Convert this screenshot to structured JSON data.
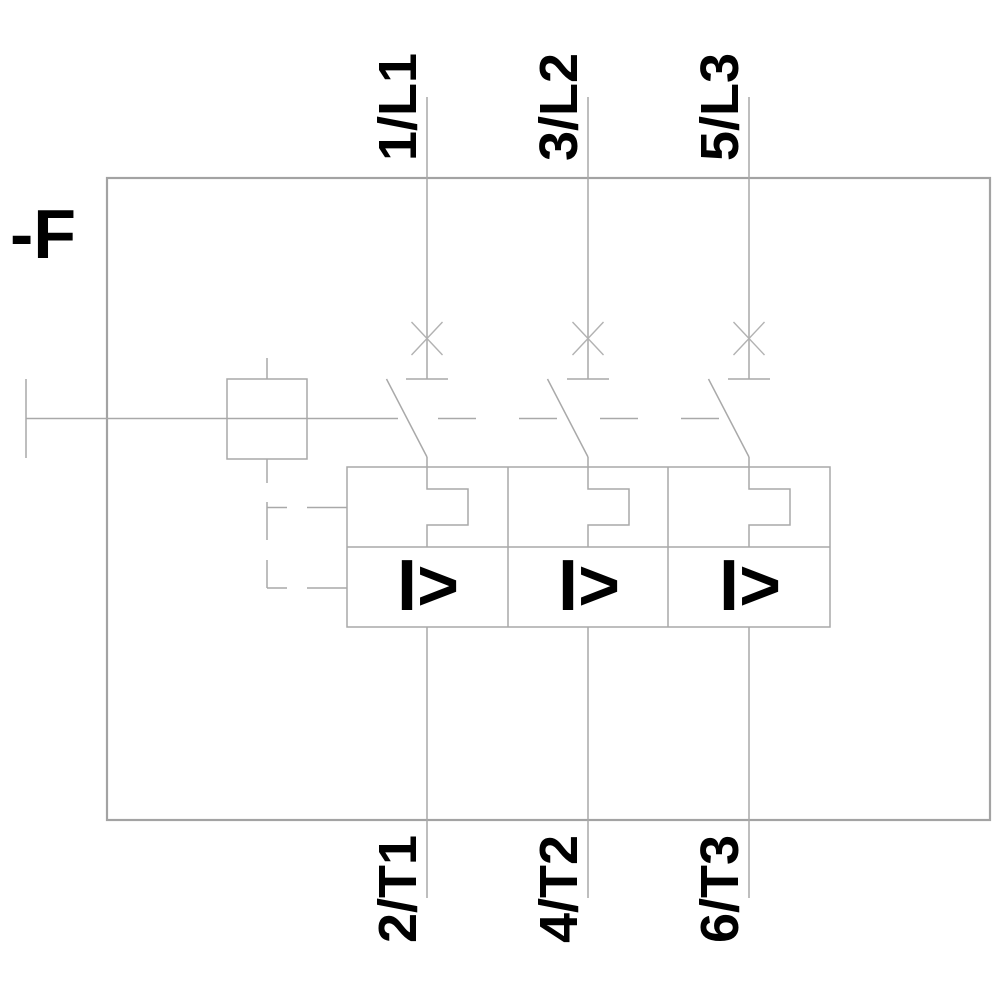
{
  "diagram": {
    "kind": "three-pole circuit-breaker (motor starter protector) schematic",
    "device_designation": "-F",
    "magnetic_trip_symbol": "I>",
    "colors": {
      "line_gray": "#a9a9a9",
      "symbol_black": "#000000",
      "background": "#ffffff"
    },
    "poles": [
      {
        "top_terminal": "1/L1",
        "bottom_terminal": "2/T1"
      },
      {
        "top_terminal": "3/L2",
        "bottom_terminal": "4/T2"
      },
      {
        "top_terminal": "5/L3",
        "bottom_terminal": "6/T3"
      }
    ]
  }
}
